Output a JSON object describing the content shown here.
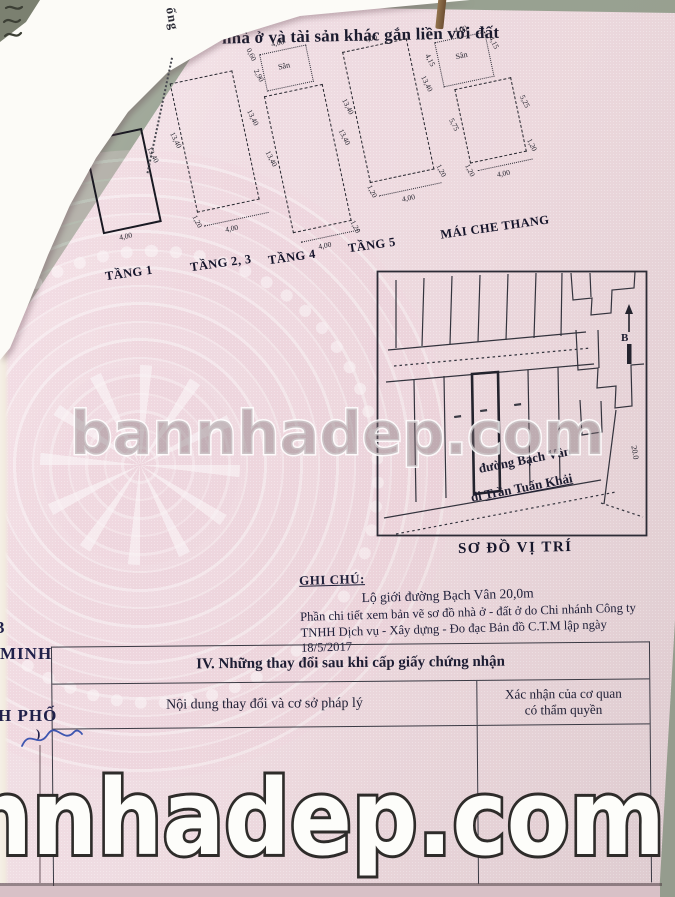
{
  "doc_title": "nhà ở và tài sản khác gắn liền với đất",
  "fold_text": "ống",
  "floor_plans": [
    {
      "label": "TẦNG 1",
      "w": "4,00",
      "h": "13,40"
    },
    {
      "label": "TẦNG 2, 3",
      "w": "4,00",
      "h": "13,40",
      "s": "1,20"
    },
    {
      "label": "TẦNG 4",
      "w": "4,00",
      "h": "13,40",
      "s": "1,20",
      "san": "Sân",
      "san_w": "4,00",
      "san_dims": [
        "0,60",
        "2,90"
      ]
    },
    {
      "label": "TẦNG 5",
      "w": "4,00",
      "h": "13,40",
      "s": "1,20",
      "top": "4,00"
    },
    {
      "label": "MÁI CHE THANG",
      "w": "4,00",
      "s": "1,20",
      "san": "Sân",
      "san_w": "4,00",
      "san_h": "4,15",
      "left": "5,75",
      "right": "5,25"
    }
  ],
  "site_map": {
    "caption": "SƠ ĐỒ VỊ TRÍ",
    "street1": "đường Bạch Vân",
    "street2_prefix": "đi ",
    "street2_name": "Trần Tuấn Khải",
    "north_label": "B",
    "road_width_label": "20.0"
  },
  "notes": {
    "heading": "GHI CHÚ:",
    "line1": "Lộ giới đường Bạch Vân 20,0m",
    "line2": "Phần chi tiết xem bản vẽ sơ đồ nhà ở - đất ở do Chi nhánh Công ty",
    "line3": "TNHH Dịch vụ - Xây dựng - Đo đạc Bản đồ C.T.M lập ngày 18/5/2017"
  },
  "section4": {
    "title": "IV. Những thay đổi sau khi cấp giấy chứng nhận",
    "col1_header": "Nội dung thay đổi và cơ sở pháp lý",
    "col2_header_line1": "Xác nhận của cơ quan",
    "col2_header_line2": "có thẩm quyền"
  },
  "left_edge": {
    "frag1": "3",
    "frag2": "MINH",
    "frag3": "H PHỐ",
    "frag4": ")"
  },
  "watermarks": {
    "middle": "bannhadep.com",
    "bottom": "annhadep.com"
  },
  "colors": {
    "page_pink": "#efdce2",
    "background_green": "#98a191",
    "ink": "#1d1d33",
    "signature_blue": "#3e56b0",
    "watermark_white": "#ffffff"
  }
}
